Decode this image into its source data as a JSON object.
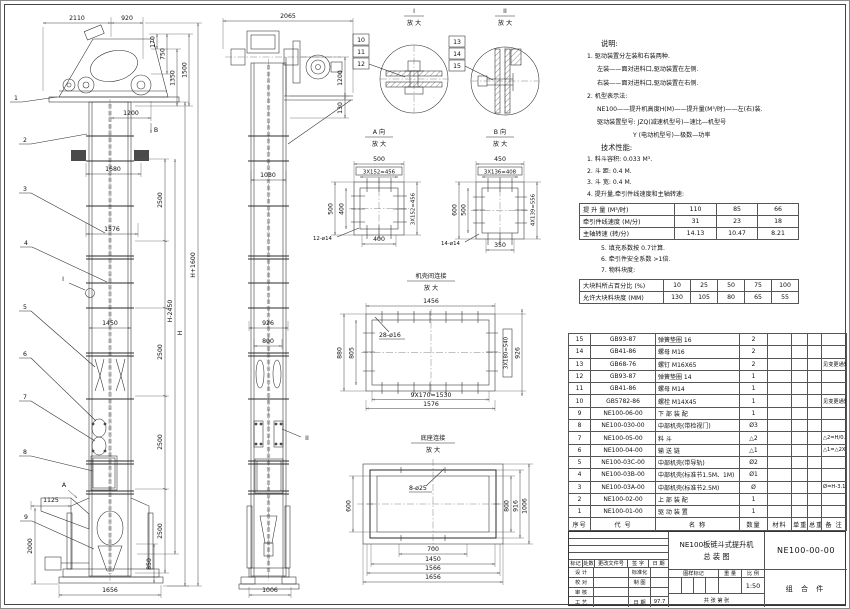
{
  "front": {
    "d2110": "2110",
    "d920": "920",
    "d170": "170",
    "d750": "750",
    "d1350": "1350",
    "d1500": "1500",
    "d1200": "1200",
    "d1680": "1680",
    "d2500": "2500",
    "d1576": "1576",
    "dHminus": "H-2450",
    "dH": "H",
    "dHplus": "H+1600",
    "d1450": "1450",
    "d1125": "1125",
    "d2000": "2000",
    "d850": "850",
    "d1656": "1656",
    "marker_a": "A",
    "marker_b": "B",
    "marker_i": "I",
    "balloons": [
      "1",
      "2",
      "3",
      "4",
      "5",
      "6",
      "7",
      "8",
      "9"
    ]
  },
  "side": {
    "d2065": "2065",
    "d1200": "1200",
    "d130": "130",
    "d1030": "1030",
    "d926": "926",
    "d800": "800",
    "d1006": "1006",
    "marker_ii": "II"
  },
  "detail_i": {
    "title": "I",
    "sub": "放 大",
    "balloons": [
      "10",
      "11",
      "12"
    ]
  },
  "detail_ii": {
    "title": "II",
    "sub": "放 大",
    "balloons": [
      "13",
      "14",
      "15"
    ]
  },
  "view_a": {
    "title": "A 向",
    "sub": "放 大",
    "top": "500",
    "top2": "3X152=456",
    "left": "500",
    "left2": "400",
    "right": "3X152=456",
    "bottom": "400",
    "holes": "12-ø14"
  },
  "view_b": {
    "title": "B 向",
    "sub": "放 大",
    "top": "450",
    "top2": "3X136=408",
    "left": "600",
    "left2": "500",
    "right": "4X139=556",
    "bottom": "350",
    "holes": "14-ø14"
  },
  "joint": {
    "title": "机壳间连接",
    "sub": "放 大",
    "top": "1456",
    "holes": "28-ø16",
    "left": "880",
    "left2": "805",
    "right2": "3X180=540",
    "right": "926",
    "bottom": "9X170=1530",
    "bottom2": "1576"
  },
  "base": {
    "title": "底座连接",
    "sub": "放 大",
    "holes": "8-ø25",
    "left": "600",
    "r800": "800",
    "r916": "916",
    "r1006": "1006",
    "b700": "700",
    "b1450": "1450",
    "b1566": "1566",
    "b1656": "1656"
  },
  "notes": {
    "heading": "说明:",
    "lines": [
      "1. 驱动装置分左装和右装两种.",
      "左装——面对进料口,驱动装置在左侧.",
      "右装——面对进料口,驱动装置在右侧.",
      "2. 机型表示法:",
      "NE100——提升机高度H(M)——提升量(M³/时)——左(右)装.",
      "驱动装置型号: JZQ(减速机型号)—速比—机型号",
      "Y (电动机型号)—极数—功率"
    ]
  },
  "tech": {
    "heading": "技术性能:",
    "lines": [
      "1. 料斗容积: 0.033 M³.",
      "2. 斗  距: 0.4 M.",
      "3. 斗  宽: 0.4 M.",
      "4. 提升量,牵引件线速度和主轴转速:"
    ],
    "lines2": [
      "5. 填充系数按 0.7计算.",
      "6. 牵引件安全系数 >1倍.",
      "7. 物料块度:"
    ]
  },
  "lift_table": {
    "rows": [
      {
        "label": "提 升 量 (M³/时)",
        "values": [
          "110",
          "85",
          "66"
        ]
      },
      {
        "label": "牵引件线速度 (M/分)",
        "values": [
          "31",
          "23",
          "18"
        ]
      },
      {
        "label": "主轴转速 (转/分)",
        "values": [
          "14.13",
          "10.47",
          "8.21"
        ]
      }
    ]
  },
  "lump_table": {
    "rows": [
      {
        "label": "大块料所占百分比 (%)",
        "values": [
          "10",
          "25",
          "50",
          "75",
          "100"
        ]
      },
      {
        "label": "允许大块料块度 (MM)",
        "values": [
          "130",
          "105",
          "80",
          "65",
          "55"
        ]
      }
    ]
  },
  "bom": {
    "headers": [
      "序号",
      "代  号",
      "名  称",
      "数量",
      "材料",
      "单重",
      "总重",
      "备 注"
    ],
    "rows": [
      [
        "15",
        "GB93-87",
        "弹簧垫圈 16",
        "2",
        "",
        "",
        "",
        ""
      ],
      [
        "14",
        "GB41-86",
        "螺母 M16",
        "2",
        "",
        "",
        "",
        ""
      ],
      [
        "13",
        "GB68-76",
        "螺钉 M16X65",
        "2",
        "",
        "",
        "",
        "见变更通知单"
      ],
      [
        "12",
        "GB93-87",
        "弹簧垫圈 14",
        "1",
        "",
        "",
        "",
        ""
      ],
      [
        "11",
        "GB41-86",
        "螺母 M14",
        "1",
        "",
        "",
        "",
        ""
      ],
      [
        "10",
        "GB5782-86",
        "螺栓 M14X45",
        "1",
        "",
        "",
        "",
        "见变更通知单"
      ],
      [
        "9",
        "NE100-06-00",
        "下 部 装 配",
        "1",
        "",
        "",
        "",
        ""
      ],
      [
        "8",
        "NE100-030-00",
        "中部机壳(带检视门)",
        "Ø3",
        "",
        "",
        "",
        ""
      ],
      [
        "7",
        "NE100-05-00",
        "料  斗",
        "△2",
        "",
        "",
        "",
        "△2=H/0.2+5.75"
      ],
      [
        "6",
        "NE100-04-00",
        "输 送 链",
        "△1",
        "",
        "",
        "",
        "△1=△2X4"
      ],
      [
        "5",
        "NE100-03C-00",
        "中部机壳(带导轨)",
        "Ø2",
        "",
        "",
        "",
        ""
      ],
      [
        "4",
        "NE100-03B-00",
        "中部机壳(标准节1.5M、1M)",
        "Ø1",
        "",
        "",
        "",
        ""
      ],
      [
        "3",
        "NE100-03A-00",
        "中部机壳(标准节2.5M)",
        "Ø",
        "",
        "",
        "",
        "Ø=H-3.15/2.5"
      ],
      [
        "2",
        "NE100-02-00",
        "上 部 装 配",
        "1",
        "",
        "",
        "",
        ""
      ],
      [
        "1",
        "NE100-01-00",
        "驱 动 装 置",
        "1",
        "",
        "",
        "",
        ""
      ]
    ]
  },
  "title_block": {
    "product": "NE100板链斗式提升机",
    "sheet_name": "总  装  图",
    "drawing_no": "NE100-00-00",
    "part_type": "组 合 件",
    "scale": "1:50",
    "date": "97.7",
    "mark": "标记",
    "count": "处数",
    "change_doc": "更改文件号",
    "sign": "签 字",
    "date_lbl": "日 期",
    "design": "设 计",
    "checked": "校 对",
    "audit": "审 核",
    "process": "工 艺",
    "standard": "标准化",
    "draft": "制 图",
    "date_lbl2": "日 期",
    "stamp": "图样标记",
    "weight": "重 量",
    "scale_lbl": "比 例",
    "sheets": "共  张  第  张"
  }
}
